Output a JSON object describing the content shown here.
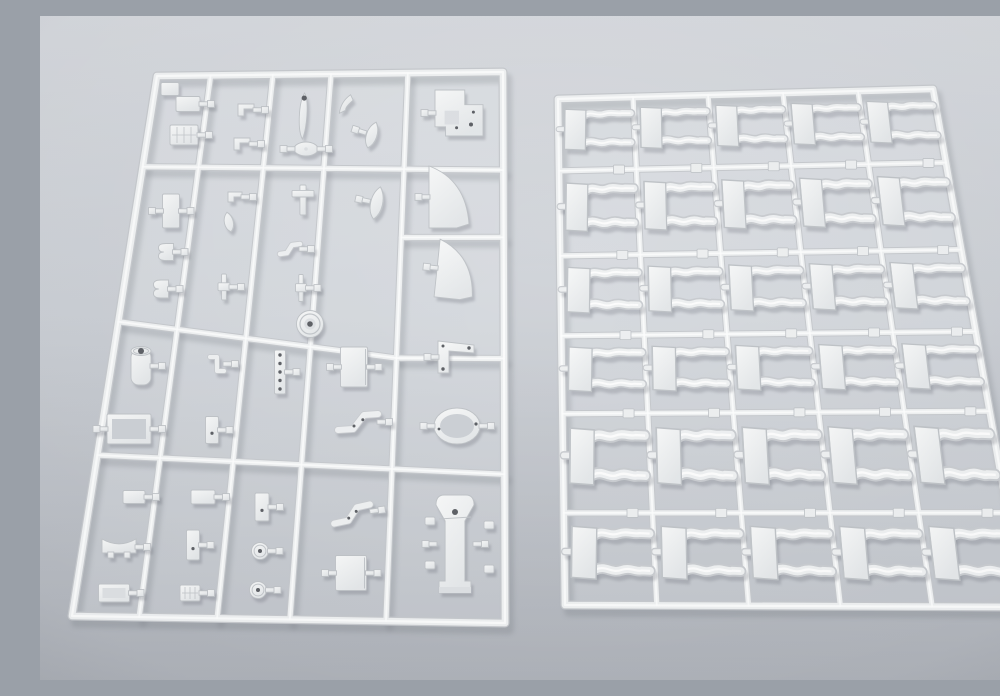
{
  "scene": {
    "width": 1000,
    "height": 664,
    "subject": "two-white-plastic-model-sprues-on-gray-surface"
  },
  "palette": {
    "bg_top": "#d3d6db",
    "bg_mid": "#c8ccd2",
    "bg_bottom": "#adb1b8",
    "plastic_light": "#f7f8f8",
    "plastic_dark": "#e4e7e9",
    "runner_edge": "#c6c9cd",
    "runner_core": "#eef0f1",
    "runner_highlight": "#fcfdfd",
    "part_edge": "#bfc3c7",
    "part_edge2": "#c9ccd0",
    "detail": "#c2c6ca",
    "mid_shade": "#dde0e3",
    "inner_hole": "#ccd0d5",
    "hole": "#5e6166",
    "part_shadow": "rgba(104,109,118,0.45)",
    "runner_shadow": "rgba(104,109,118,0.40)",
    "inner_tint": "rgba(234,238,241,0.28)",
    "pad_fill": "#edeff0"
  },
  "left_sprue": {
    "corners": {
      "tl": [
        117,
        60
      ],
      "tr": [
        463,
        56
      ],
      "br": [
        465,
        607
      ],
      "bl": [
        32,
        600
      ]
    },
    "v_runners": [
      {
        "t": 0.155
      },
      {
        "t": 0.335
      },
      {
        "t": 0.503
      },
      {
        "t": 0.725
      }
    ],
    "h_runners": [
      {
        "u0": 0,
        "u1": 1,
        "v0": 0.168,
        "v1": 0.178
      },
      {
        "u0": 0,
        "u1": 0.725,
        "v0": 0.455,
        "v1": 0.52
      },
      {
        "u0": 0.725,
        "u1": 1,
        "v0": 0.3,
        "v1": 0.3
      },
      {
        "u0": 0.725,
        "u1": 1,
        "v0": 0.52,
        "v1": 0.52
      },
      {
        "u0": 0,
        "u1": 1,
        "v0": 0.702,
        "v1": 0.73
      }
    ],
    "parts": [
      {
        "t": "pad",
        "x": 130,
        "y": 73,
        "w": 18,
        "h": 13
      },
      {
        "t": "rect",
        "x": 148,
        "y": 88,
        "w": 24,
        "h": 15,
        "stubs": [
          "R"
        ]
      },
      {
        "t": "hatch",
        "x": 144,
        "y": 119,
        "w": 28,
        "h": 20,
        "stubs": [
          "R"
        ]
      },
      {
        "t": "bracket",
        "x": 206,
        "y": 94,
        "w": 16,
        "h": 12,
        "stubs": [
          "R"
        ]
      },
      {
        "t": "bracket",
        "x": 202,
        "y": 128,
        "w": 16,
        "h": 12,
        "stubs": [
          "R"
        ]
      },
      {
        "t": "blade",
        "x": 263,
        "y": 100,
        "w": 11,
        "h": 46,
        "r": 4
      },
      {
        "t": "oval",
        "x": 266,
        "y": 133,
        "w": 24,
        "h": 14,
        "stubs": [
          "L",
          "R"
        ]
      },
      {
        "t": "wing",
        "x": 305,
        "y": 88,
        "w": 18,
        "h": 12,
        "r": -25
      },
      {
        "t": "teardrop",
        "x": 332,
        "y": 119,
        "w": 14,
        "h": 27,
        "r": 18,
        "stubs": [
          "L"
        ]
      },
      {
        "t": "panel",
        "x": 419,
        "y": 97,
        "w": 48,
        "h": 46,
        "stubs": [
          "L"
        ]
      },
      {
        "t": "plateV",
        "x": 131,
        "y": 195,
        "w": 17,
        "h": 34,
        "stubs": [
          "L",
          "R"
        ]
      },
      {
        "t": "clampB",
        "x": 126,
        "y": 236,
        "w": 15,
        "h": 17,
        "stubs": [
          "R"
        ]
      },
      {
        "t": "clampB",
        "x": 121,
        "y": 273,
        "w": 15,
        "h": 18,
        "stubs": [
          "R"
        ]
      },
      {
        "t": "bracket",
        "x": 195,
        "y": 181,
        "w": 14,
        "h": 10,
        "stubs": [
          "R"
        ]
      },
      {
        "t": "leaf",
        "x": 189,
        "y": 206,
        "w": 12,
        "h": 20,
        "r": -12
      },
      {
        "t": "tbar",
        "x": 184,
        "y": 271,
        "w": 12,
        "h": 26,
        "stubs": [
          "R"
        ]
      },
      {
        "t": "cross",
        "x": 263,
        "y": 184,
        "w": 22,
        "h": 30
      },
      {
        "t": "zig",
        "x": 250,
        "y": 233,
        "w": 20,
        "h": 14,
        "stubs": [
          "R"
        ]
      },
      {
        "t": "tbar",
        "x": 261,
        "y": 272,
        "w": 11,
        "h": 27,
        "stubs": [
          "R"
        ]
      },
      {
        "t": "teardrop",
        "x": 337,
        "y": 187,
        "w": 16,
        "h": 33,
        "r": 12,
        "stubs": [
          "L"
        ]
      },
      {
        "t": "fender",
        "x": 409,
        "y": 181,
        "w": 40,
        "h": 62,
        "stubs": [
          "L"
        ]
      },
      {
        "t": "fender",
        "x": 416,
        "y": 254,
        "w": 38,
        "h": 58,
        "r": 6,
        "stubs": [
          "L"
        ]
      },
      {
        "t": "cyl",
        "x": 101,
        "y": 350,
        "w": 20,
        "h": 38,
        "stubs": [
          "R"
        ]
      },
      {
        "t": "frame",
        "x": 89,
        "y": 413,
        "w": 44,
        "h": 30,
        "stubs": [
          "L",
          "R"
        ]
      },
      {
        "t": "brkS",
        "x": 177,
        "y": 348,
        "w": 14,
        "h": 18,
        "stubs": [
          "R"
        ]
      },
      {
        "t": "barV",
        "x": 172,
        "y": 414,
        "w": 13,
        "h": 27,
        "stubs": [
          "R"
        ]
      },
      {
        "t": "holebar",
        "x": 240,
        "y": 356,
        "w": 11,
        "h": 44,
        "stubs": [
          "R"
        ]
      },
      {
        "t": "hub",
        "x": 270,
        "y": 308,
        "w": 27,
        "h": 27
      },
      {
        "t": "sq",
        "x": 314,
        "y": 351,
        "w": 27,
        "h": 40,
        "stubs": [
          "L",
          "R"
        ]
      },
      {
        "t": "zigarm",
        "x": 318,
        "y": 406,
        "w": 40,
        "h": 22,
        "stubs": [
          "R"
        ]
      },
      {
        "t": "lbr",
        "x": 416,
        "y": 341,
        "w": 36,
        "h": 32,
        "stubs": [
          "L"
        ]
      },
      {
        "t": "ring",
        "x": 417,
        "y": 410,
        "w": 46,
        "h": 36,
        "stubs": [
          "L",
          "R"
        ]
      },
      {
        "t": "rect",
        "x": 94,
        "y": 481,
        "w": 22,
        "h": 13,
        "stubs": [
          "R"
        ]
      },
      {
        "t": "saddle",
        "x": 79,
        "y": 531,
        "w": 34,
        "h": 22,
        "stubs": [
          "R"
        ]
      },
      {
        "t": "tray",
        "x": 74,
        "y": 577,
        "w": 31,
        "h": 18,
        "stubs": [
          "R"
        ]
      },
      {
        "t": "rect",
        "x": 163,
        "y": 481,
        "w": 24,
        "h": 14,
        "stubs": [
          "R"
        ]
      },
      {
        "t": "barV",
        "x": 153,
        "y": 529,
        "w": 13,
        "h": 30,
        "stubs": [
          "R"
        ]
      },
      {
        "t": "hatch",
        "x": 150,
        "y": 577,
        "w": 20,
        "h": 16,
        "stubs": [
          "R"
        ]
      },
      {
        "t": "barV",
        "x": 222,
        "y": 491,
        "w": 14,
        "h": 28,
        "stubs": [
          "R"
        ]
      },
      {
        "t": "disc",
        "x": 220,
        "y": 535,
        "w": 17,
        "h": 17,
        "stubs": [
          "R"
        ]
      },
      {
        "t": "disc",
        "x": 218,
        "y": 574,
        "w": 17,
        "h": 17,
        "stubs": [
          "R"
        ]
      },
      {
        "t": "zigarm",
        "x": 312,
        "y": 498,
        "w": 38,
        "h": 20,
        "r": -8,
        "stubs": [
          "R"
        ]
      },
      {
        "t": "sq",
        "x": 311,
        "y": 557,
        "w": 31,
        "h": 35,
        "stubs": [
          "L",
          "R"
        ]
      },
      {
        "t": "mount",
        "x": 415,
        "y": 528,
        "w": 38,
        "h": 98,
        "stubs": [
          "L",
          "R"
        ]
      },
      {
        "t": "pad",
        "x": 390,
        "y": 505,
        "w": 10,
        "h": 8
      },
      {
        "t": "pad",
        "x": 449,
        "y": 509,
        "w": 10,
        "h": 8
      },
      {
        "t": "pad",
        "x": 390,
        "y": 549,
        "w": 10,
        "h": 8
      },
      {
        "t": "pad",
        "x": 449,
        "y": 553,
        "w": 10,
        "h": 8
      }
    ]
  },
  "right_sprue": {
    "corners": {
      "tl": [
        518,
        83
      ],
      "tr": [
        893,
        73
      ],
      "br": [
        984,
        591
      ],
      "bl": [
        525,
        589
      ]
    },
    "cols": 5,
    "rows": 6,
    "col_edges": [
      0,
      0.2,
      0.4,
      0.6,
      0.8,
      1
    ],
    "row_edges": [
      0,
      0.142,
      0.31,
      0.468,
      0.622,
      0.818,
      1
    ],
    "gate_pad": {
      "w": 11,
      "h": 9,
      "u_offset": 0.155
    }
  }
}
